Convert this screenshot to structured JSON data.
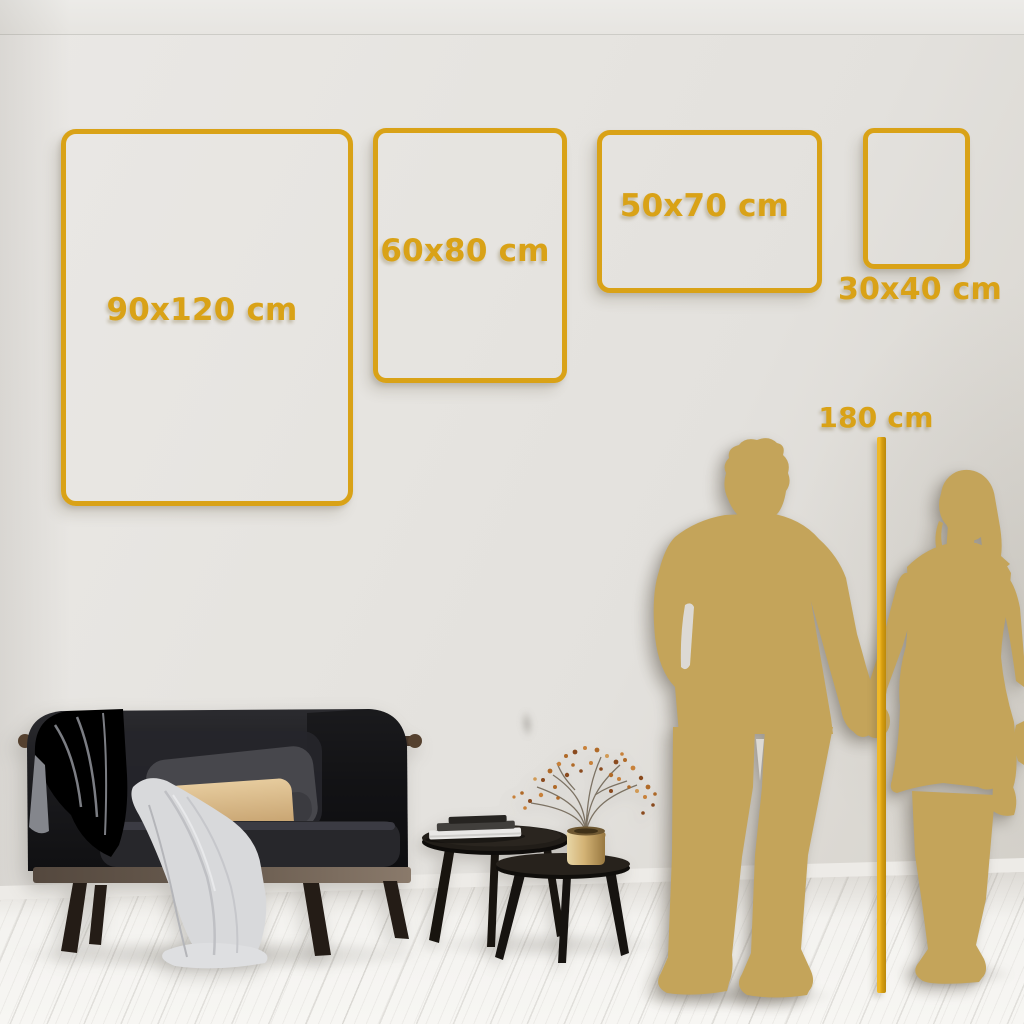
{
  "size_guide": {
    "frames": [
      {
        "label": "90x120 cm"
      },
      {
        "label": "60x80 cm"
      },
      {
        "label": "50x70 cm"
      },
      {
        "label": "30x40 cm"
      }
    ],
    "height_reference": {
      "label": "180 cm"
    }
  },
  "colors": {
    "frame_gold": "#D9A217",
    "ruler_gold": "#D79E10",
    "silhouette_gold": "#C4A45A",
    "wall": "#E3E1DD",
    "floor": "#F4F3F0"
  }
}
